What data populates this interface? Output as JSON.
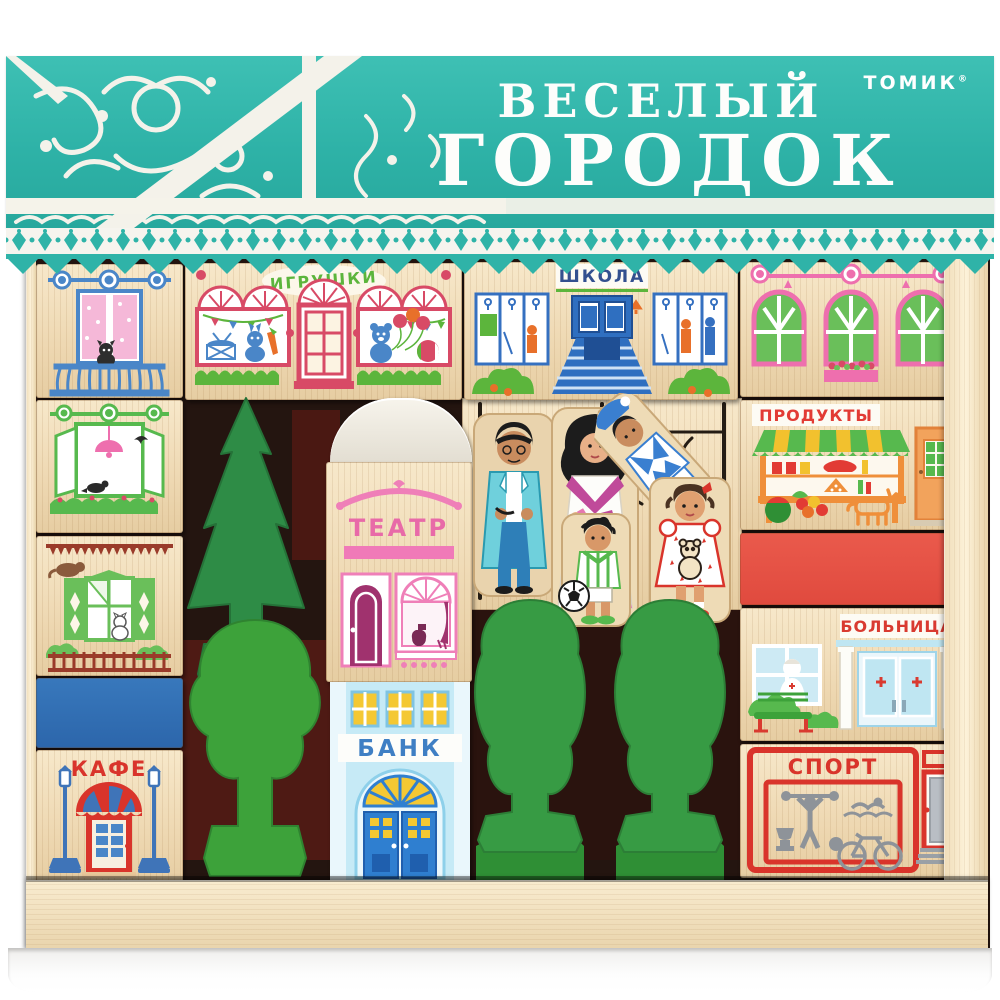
{
  "banner": {
    "title_line1": "ВЕСЕЛЫЙ",
    "title_line2": "ГОРОДОК",
    "brand": "ТОМИК",
    "registered": "®"
  },
  "blocks": {
    "toy_store": "ИГРУШКИ",
    "school": "ШКОЛА",
    "products": "ПРОДУКТЫ",
    "theater": "ТЕАТР",
    "bank": "БАНК",
    "hospital": "БОЛЬНИЦА",
    "cafe": "КАФЕ",
    "sport": "СПОРТ"
  },
  "colors": {
    "banner_teal": "#2FB3A8",
    "wood": "#EFDBBA",
    "crimson": "#D84A66",
    "school_blue": "#3570C0",
    "plain_red": "#E8574A",
    "plain_blue": "#2E6DB4",
    "green": "#3DA23A",
    "pink": "#EE6FAE",
    "bank_lightblue": "#BFE6F4",
    "orange": "#EF8F3A",
    "sport_gray": "#8E9399"
  }
}
